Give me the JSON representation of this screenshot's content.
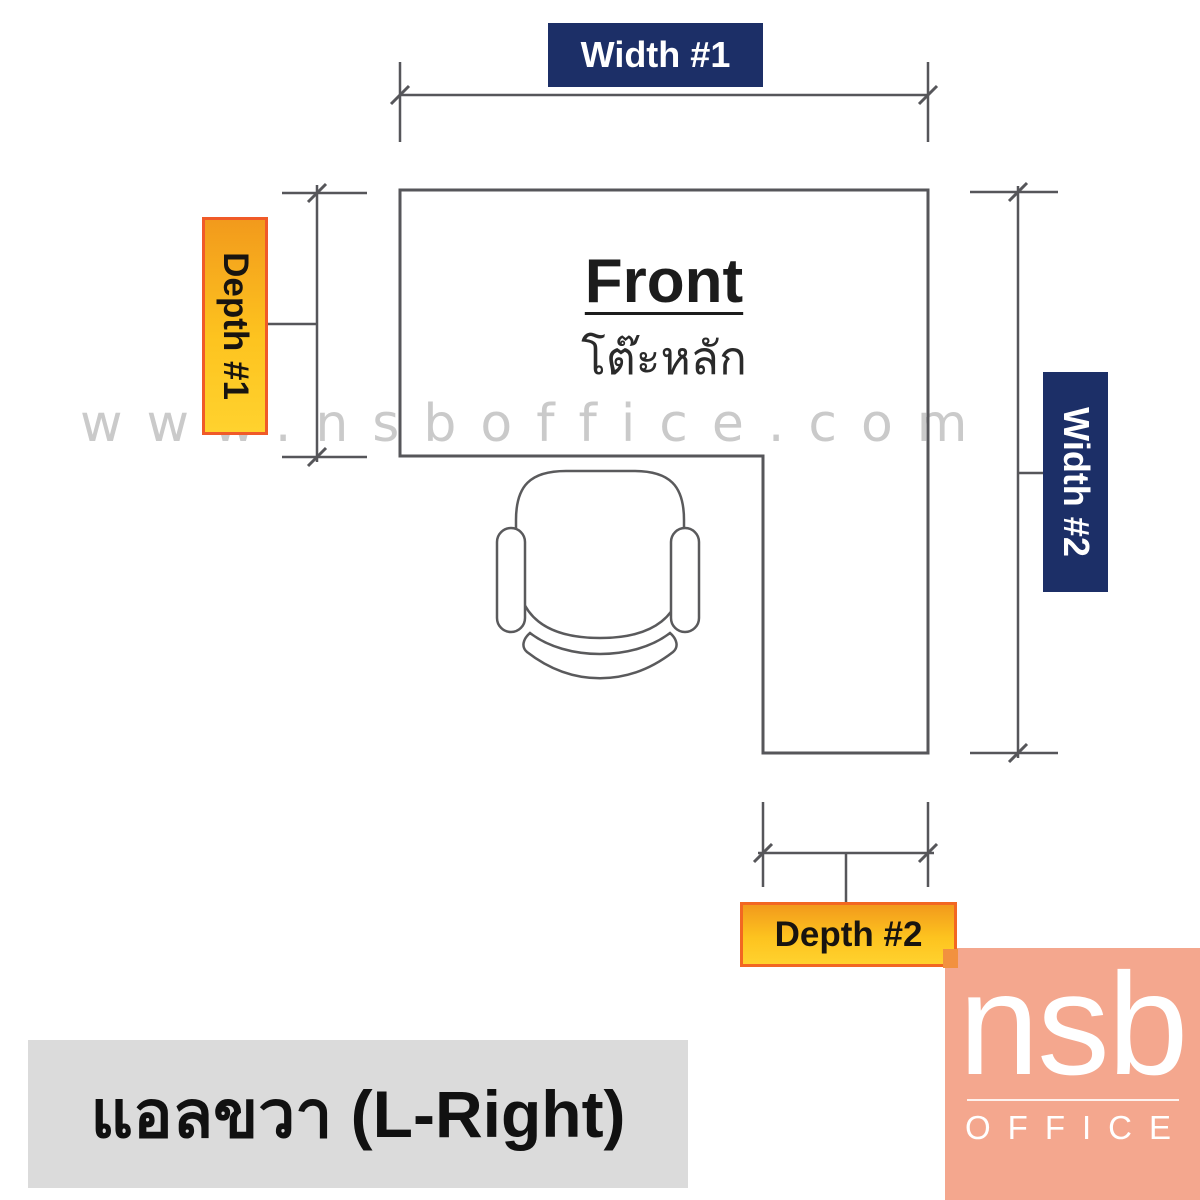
{
  "diagram": {
    "watermark": "www.nsboffice.com",
    "caption": "แอลขวา (L-Right)",
    "desk": {
      "front_label": "Front",
      "front_label_thai": "โต๊ะหลัก"
    },
    "dimension_labels": {
      "width1": "Width #1",
      "width2": "Width #2",
      "depth1": "Depth #1",
      "depth2": "Depth #2"
    },
    "logo": {
      "brand": "nsb",
      "sub_brand": "OFFICE"
    },
    "colors": {
      "dimension_label_navy": "#1c2f67",
      "dimension_label_amber": "#fdb813",
      "amber_border_red": "#f05a28",
      "amber_border_orange": "#f26722",
      "line_gray": "#56565a",
      "watermark_gray": "#cacaca",
      "caption_bg": "#dbdbdb",
      "logo_bg": "#f4a78e"
    }
  }
}
